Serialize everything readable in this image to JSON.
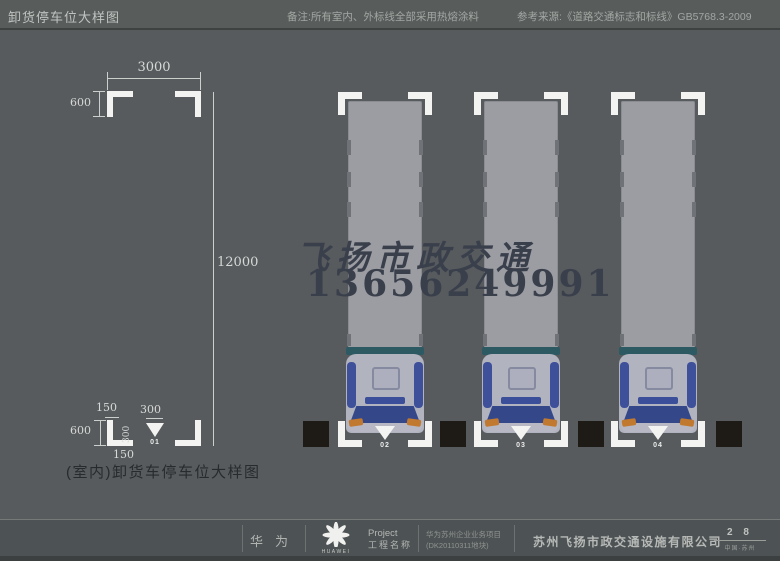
{
  "header": {
    "title": "卸货停车位大样图",
    "note": "备注:所有室内、外标线全部采用热熔涂料",
    "reference": "参考来源:《道路交通标志和标线》GB5768.3-2009"
  },
  "drawing": {
    "dim_width": "3000",
    "dim_corner_height": "600",
    "dim_length": "12000",
    "dim_150_top": "150",
    "dim_arrow_width": "300",
    "dim_arrow_height": "300",
    "dim_600_bottom": "600",
    "dim_150_bottom": "150",
    "space01_label": "01",
    "caption": "(室内)卸货车停车位大样图"
  },
  "watermark": {
    "line1": "飞扬市政交通",
    "line2": "13656249991"
  },
  "spaces": [
    {
      "label": "02"
    },
    {
      "label": "03"
    },
    {
      "label": "04"
    }
  ],
  "footer": {
    "brand": "华为",
    "logo_text": "HUAWEI",
    "project_label_en": "Project",
    "project_label_zh": "工程名称",
    "project_name_line1": "华为苏州企业业务项目",
    "project_name_line2": "(DK20110311地块)",
    "company": "苏州飞扬市政交通设施有限公司",
    "page_number": "2 8",
    "page_location": "中国·苏州"
  },
  "colors": {
    "canvas_bg": "#575b5e",
    "marking_white": "#f3f4f2",
    "trailer_gray": "#9c9da2",
    "cab_gray": "#b1b3bf",
    "windshield_blue": "#344789",
    "deflector_teal": "#2d5a62",
    "headlight_orange": "#c1792f",
    "pillar_black": "#1e1b17",
    "watermark_ink": "#3a3f4c"
  }
}
